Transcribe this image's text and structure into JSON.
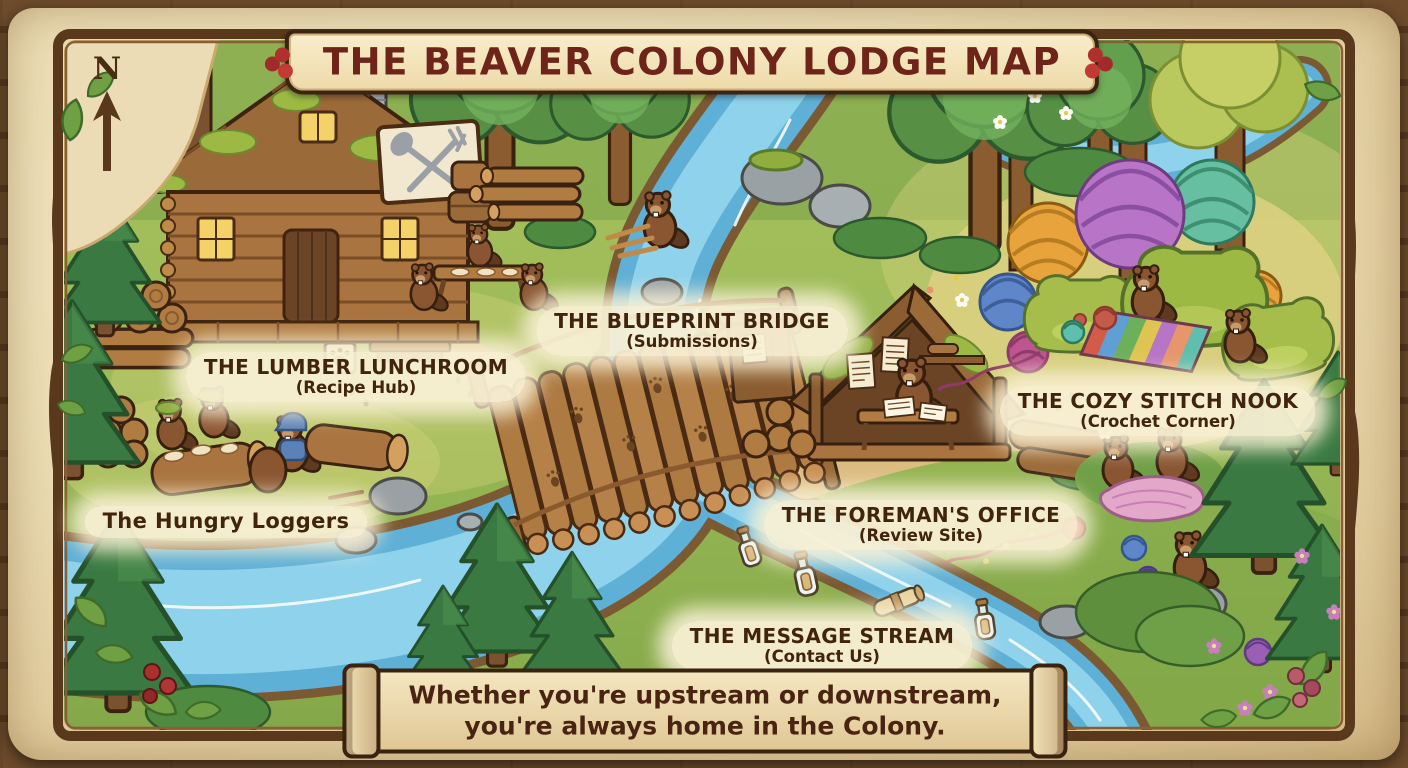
{
  "title": "THE BEAVER COLONY LODGE MAP",
  "compass": {
    "label": "N",
    "direction": "north"
  },
  "locations": [
    {
      "id": "lumber-lunchroom",
      "name": "THE LUMBER LUNCHROOM",
      "subtitle": "(Recipe Hub)"
    },
    {
      "id": "blueprint-bridge",
      "name": "THE BLUEPRINT BRIDGE",
      "subtitle": "(Submissions)"
    },
    {
      "id": "hungry-loggers",
      "name": "The Hungry Loggers",
      "subtitle": ""
    },
    {
      "id": "cozy-stitch-nook",
      "name": "THE COZY STITCH NOOK",
      "subtitle": "(Crochet Corner)"
    },
    {
      "id": "foremans-office",
      "name": "THE FOREMAN'S OFFICE",
      "subtitle": "(Review Site)"
    },
    {
      "id": "message-stream",
      "name": "THE MESSAGE STREAM",
      "subtitle": "(Contact Us)"
    }
  ],
  "footer": {
    "line1": "Whether you're upstream or downstream,",
    "line2": "you're always home in the Colony."
  },
  "icons": {
    "north_arrow": "up-arrow",
    "lodge_sign": "crossed-spoon-and-fork",
    "paw_sign": "paw-print",
    "message_bottle": "bottle-with-scroll"
  },
  "colors": {
    "river_blue": "#8fd2ec",
    "grass_green": "#9cbb58",
    "wood_brown": "#6e4c2c",
    "parchment": "#eee0ba",
    "title_text": "#6e2418",
    "label_text": "#40240d",
    "yarn_orange": "#e8a33d",
    "yarn_purple": "#b874c6",
    "yarn_teal": "#66bfa0"
  }
}
